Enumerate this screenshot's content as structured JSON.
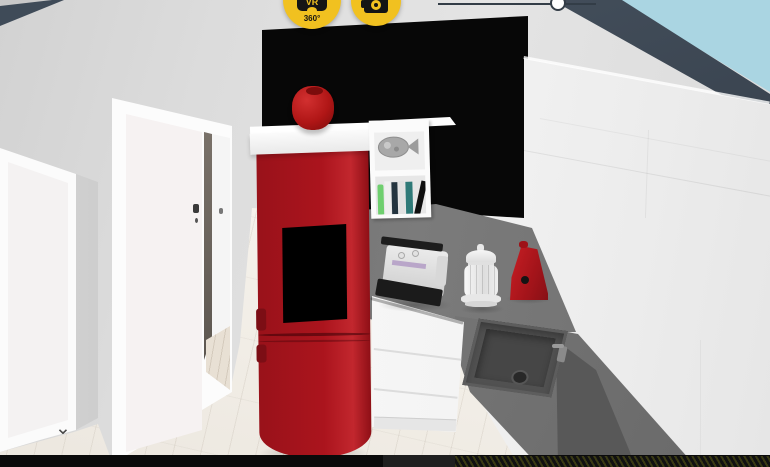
{
  "viewport": {
    "type": "3d-room-preview",
    "scene_label": "kitchen-interior-render"
  },
  "toolbar": {
    "vr_button": {
      "label": "VR",
      "sublabel": "360°",
      "icon": "vr-goggles-icon"
    },
    "camera_button": {
      "icon": "camera-icon"
    }
  },
  "controls": {
    "zoom_slider": {
      "orientation": "horizontal"
    },
    "collapse_chevron": {
      "glyph": "⌄"
    }
  },
  "colors": {
    "accent_yellow": "#f1c120",
    "sky": "#aad5e2",
    "wall_top_edge": "#3f4b58",
    "feature_wall": "#070707",
    "stove_red": "#ab141d",
    "vase_red": "#b01616",
    "counter_gray": "#6e6e6e",
    "sink_gray": "#515151",
    "cabinet_white": "#f6f6f6",
    "floor_wood": "#f1ede6",
    "bottom_bar": "#0a0a0a"
  },
  "scene": {
    "objects": [
      "feature-wall-black",
      "pellet-stove",
      "stove-window",
      "mantel-shelf",
      "red-vase",
      "cube-shelf",
      "fish-sculpture",
      "books",
      "sewing-machine",
      "white-lantern",
      "red-kettle",
      "countertop-back",
      "countertop-sink",
      "kitchen-sink",
      "faucet",
      "base-drawers",
      "wall-cabinets",
      "dark-end-panel",
      "left-door",
      "center-door",
      "hallway-door",
      "wood-floor",
      "hallway-floor",
      "sky",
      "wall-top-edge"
    ]
  }
}
